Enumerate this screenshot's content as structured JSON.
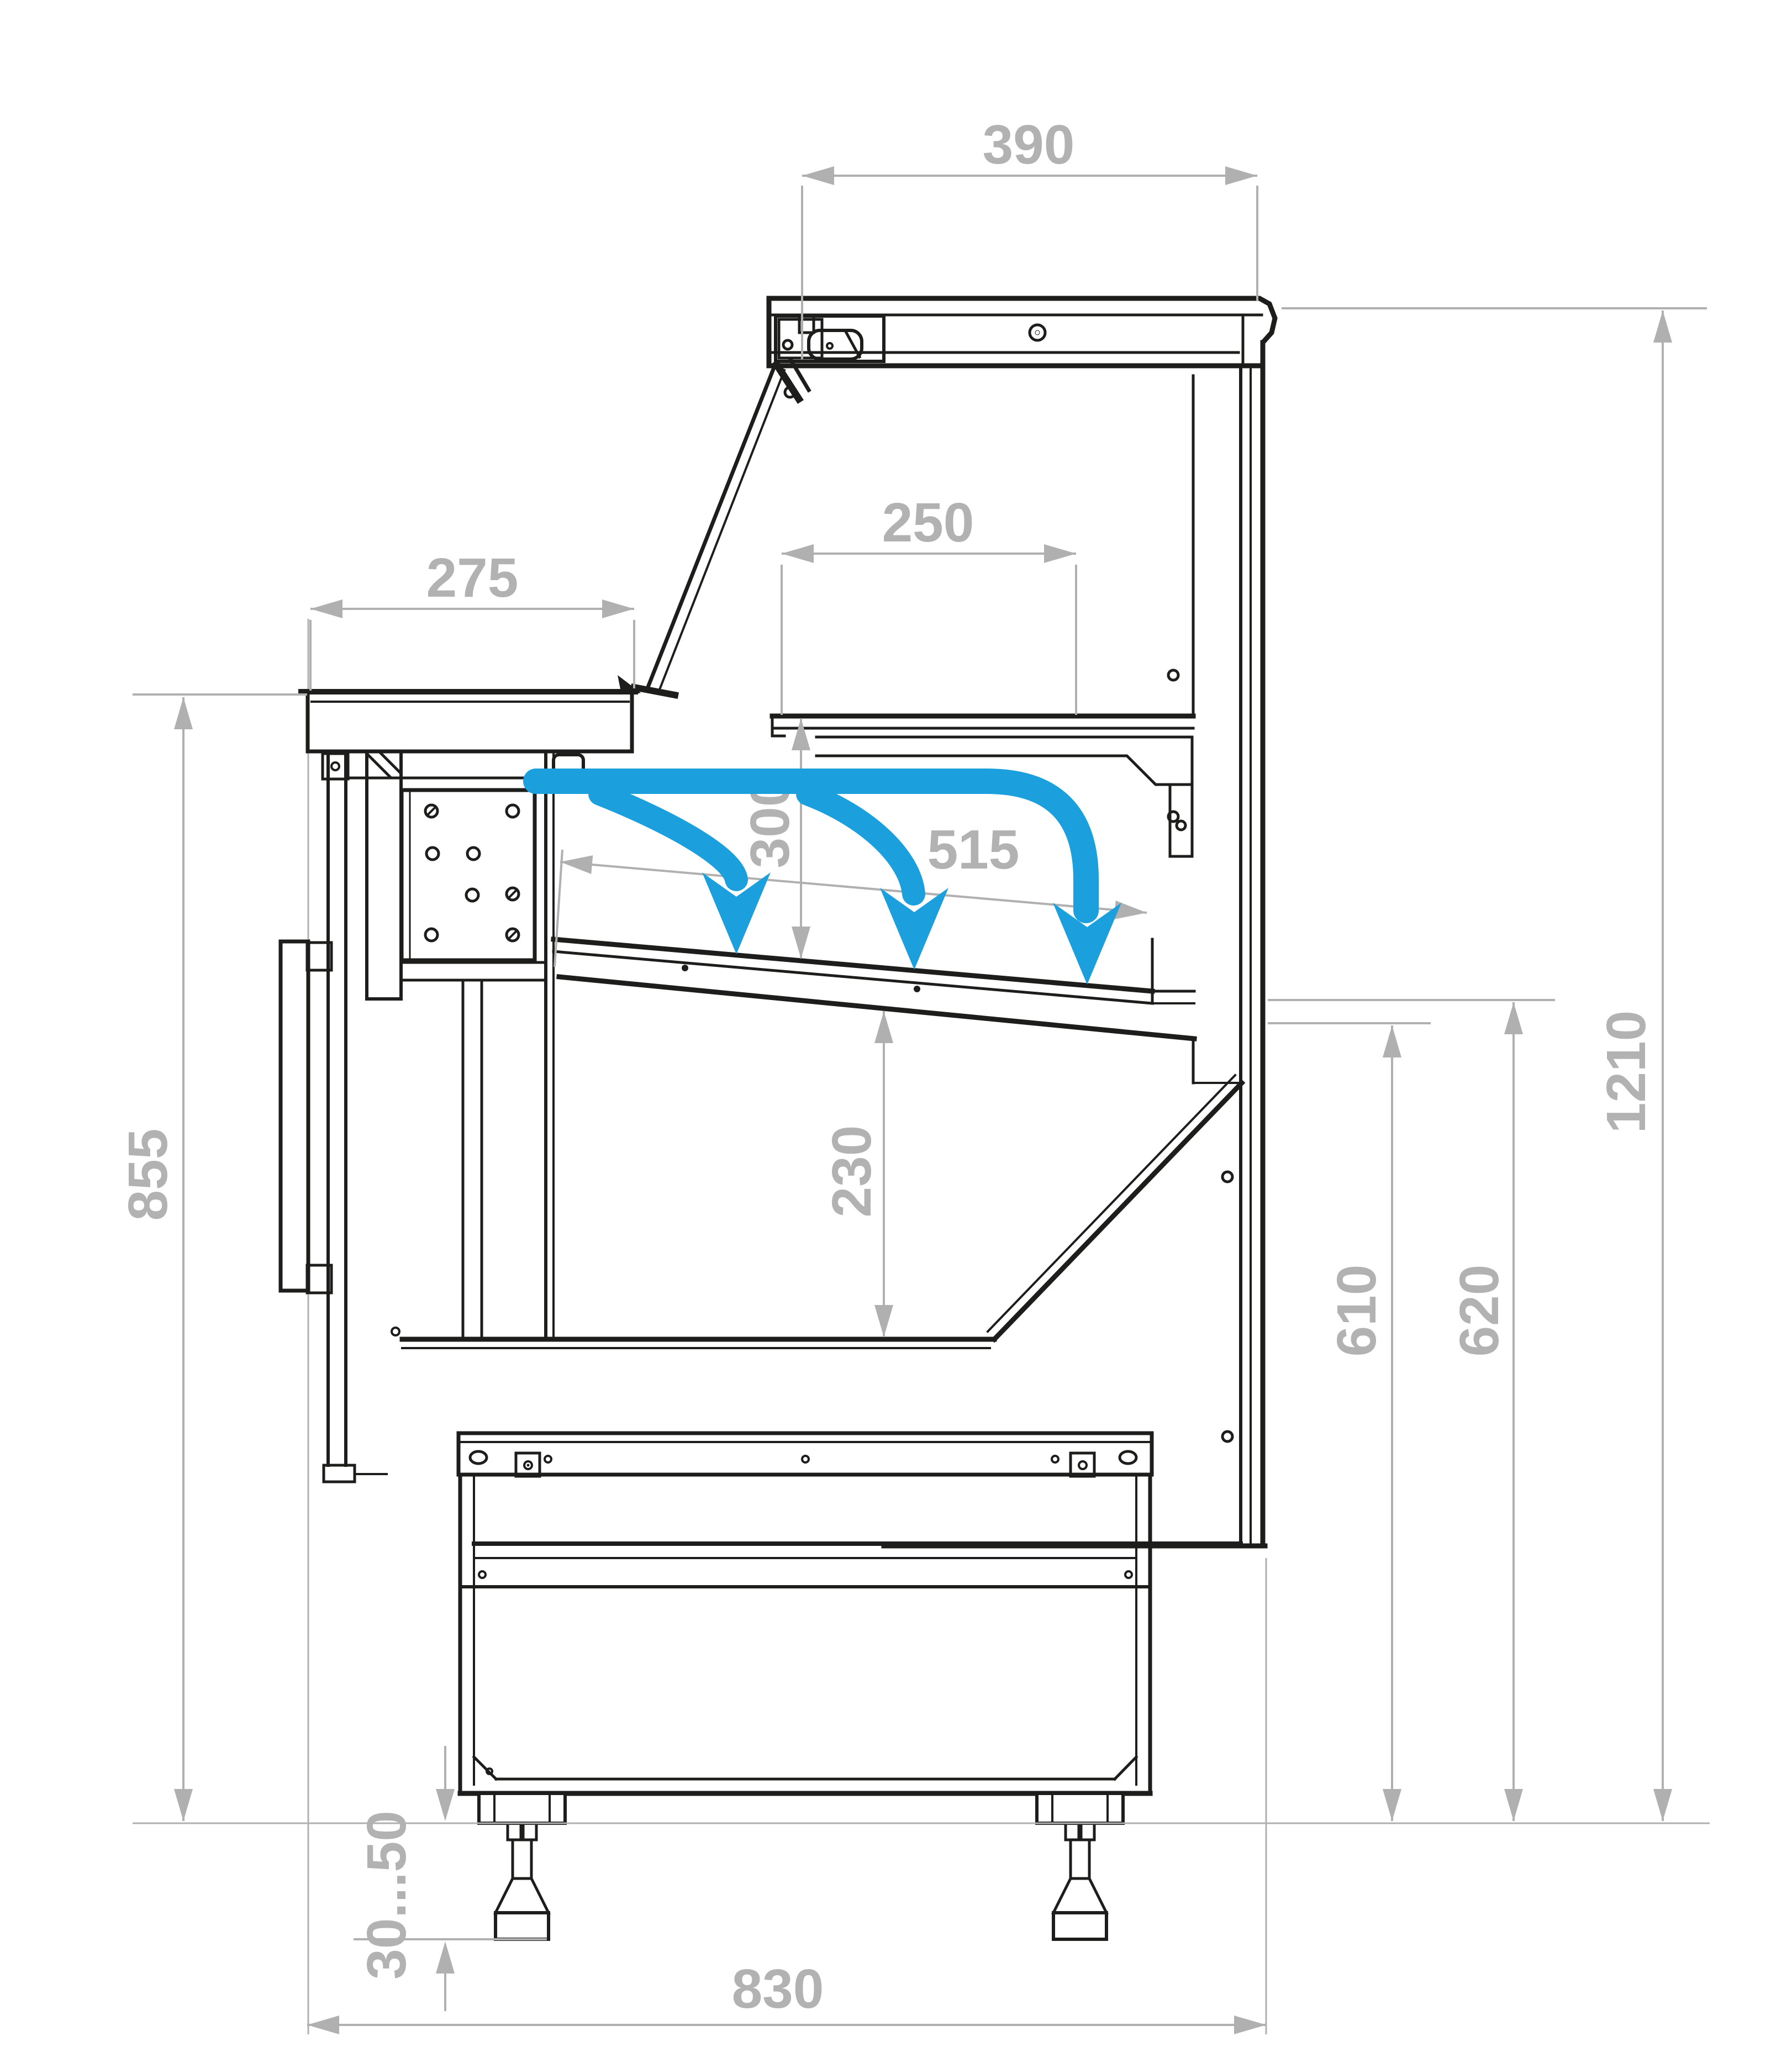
{
  "drawing": {
    "title": "refrigerated-serve-over-counter-cross-section",
    "colors": {
      "linework": "#1d1d1b",
      "dimension_gray": "#b2b2b2",
      "airflow_blue": "#1b9fdd",
      "background": "#ffffff"
    },
    "dimensions": {
      "canopy_width": "390",
      "upper_shelf_depth": "250",
      "counter_top_depth": "275",
      "shelf_clearance_height": "300",
      "display_deck_depth": "515",
      "well_depth": "230",
      "counter_front_height": "855",
      "deck_rear_height_inner": "610",
      "deck_rear_height_outer": "620",
      "overall_height": "1210",
      "foot_adjust_range": "30...50",
      "overall_depth": "830"
    },
    "icons": {
      "airflow": "curved-down-arrows"
    }
  }
}
